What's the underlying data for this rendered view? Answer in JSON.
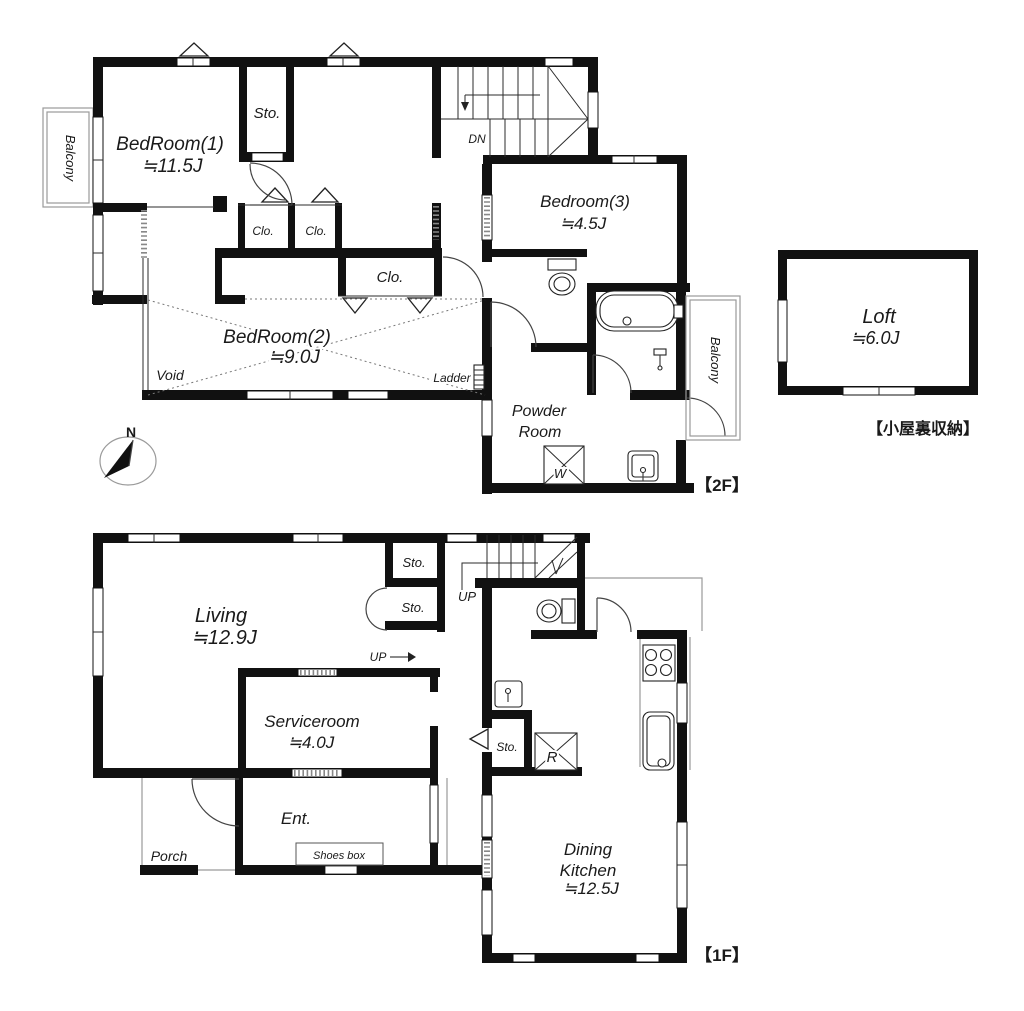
{
  "colors": {
    "wall": "#111111",
    "line": "#2b2b2b",
    "gray": "#9a9a9a",
    "text": "#1a1a1a",
    "bg": "#ffffff"
  },
  "compass": {
    "north_label": "N"
  },
  "floor2": {
    "tag": "【2F】",
    "attic_tag": "【小屋裏収納】",
    "bedroom1": {
      "name": "BedRoom(1)",
      "size": "≒11.5J"
    },
    "bedroom2": {
      "name": "BedRoom(2)",
      "size": "≒9.0J"
    },
    "bedroom3": {
      "name": "Bedroom(3)",
      "size": "≒4.5J"
    },
    "loft": {
      "name": "Loft",
      "size": "≒6.0J"
    },
    "powder_room": {
      "line1": "Powder",
      "line2": "Room"
    },
    "storage_label": "Sto.",
    "closet_label": "Clo.",
    "down_label": "DN",
    "void_label": "Void",
    "ladder_label": "Ladder",
    "washer_label": "W",
    "balcony_label": "Balcony"
  },
  "floor1": {
    "tag": "【1F】",
    "living": {
      "name": "Living",
      "size": "≒12.9J"
    },
    "serviceroom": {
      "name": "Serviceroom",
      "size": "≒4.0J"
    },
    "dining_kitchen": {
      "line1": "Dining",
      "line2": "Kitchen",
      "size": "≒12.5J"
    },
    "entrance_label": "Ent.",
    "porch_label": "Porch",
    "shoes_box_label": "Shoes box",
    "storage_label": "Sto.",
    "up_label": "UP",
    "refrigerator_label": "R"
  }
}
